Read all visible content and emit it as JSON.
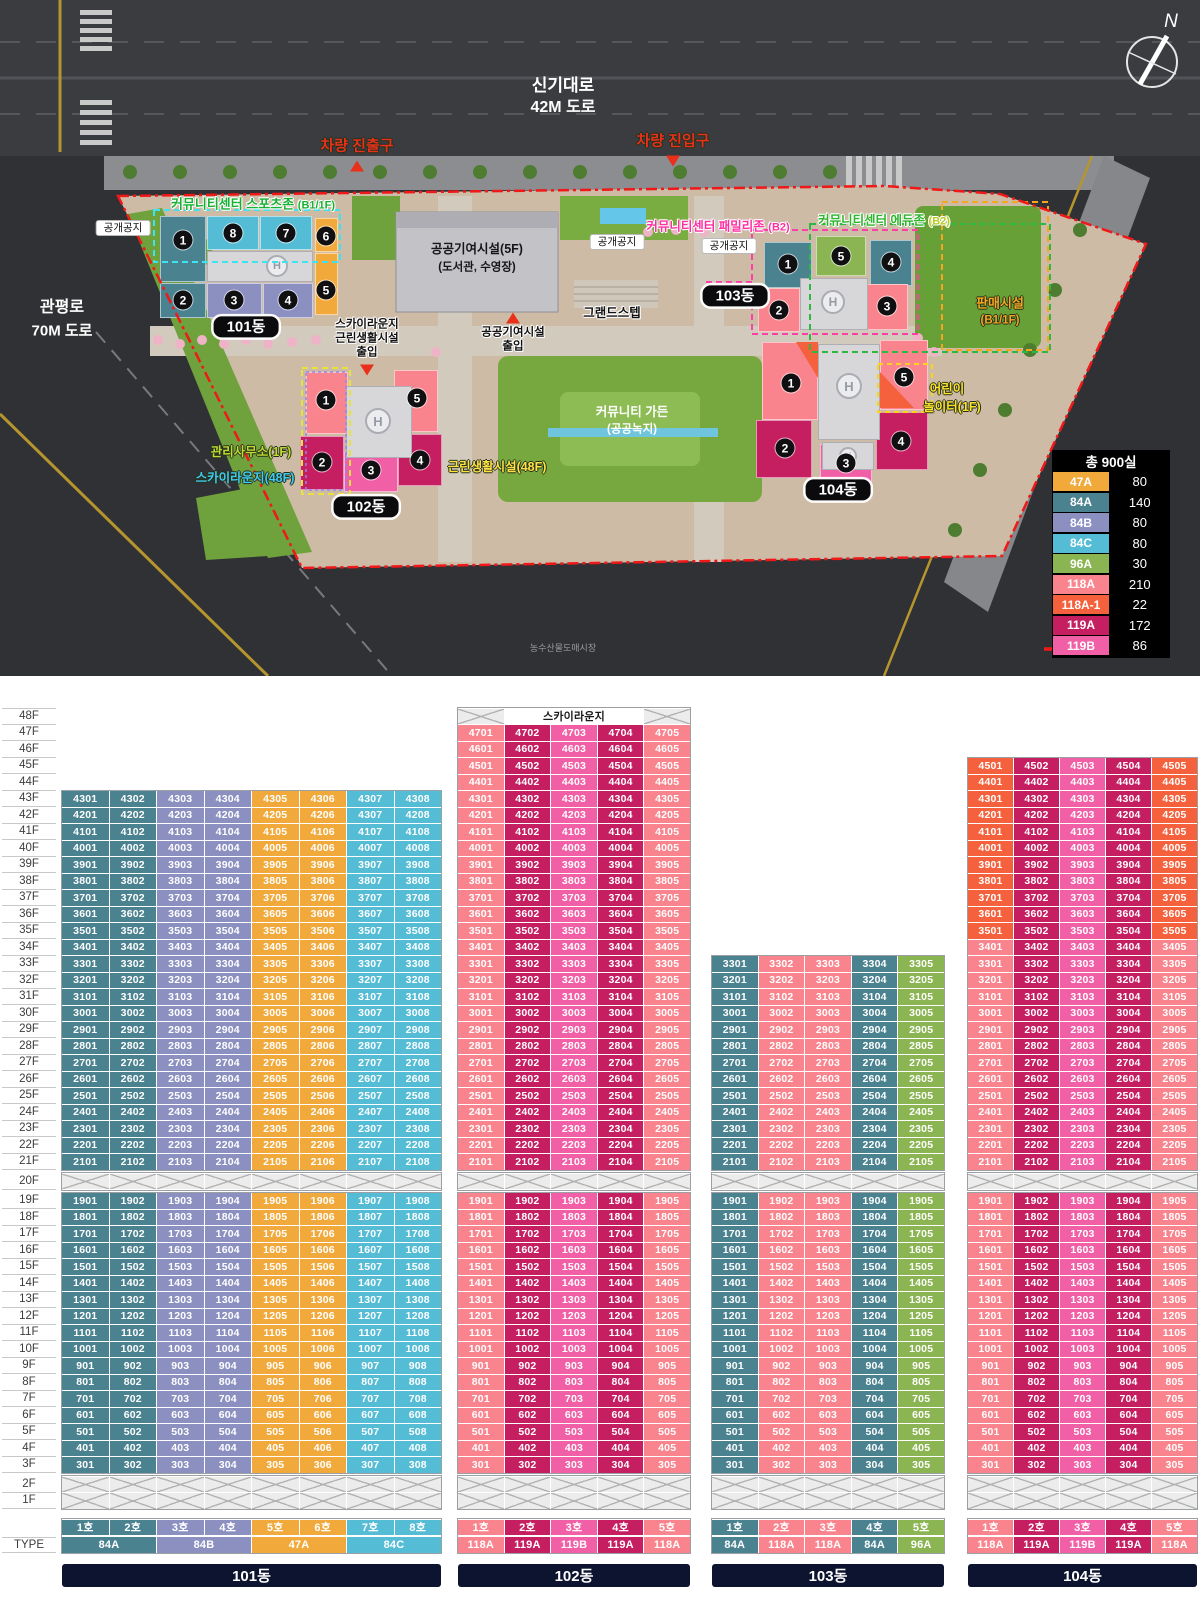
{
  "site_plan": {
    "compass_label": "N",
    "helipad_label": "H",
    "roads": {
      "top_name": "신기대로",
      "top_size": "42M 도로",
      "left_name": "관평로",
      "left_size": "70M 도로"
    },
    "gates": {
      "exit": "차량 진출구",
      "entry": "차량 진입구"
    },
    "open_space": "공개공지",
    "zones": {
      "sports": "커뮤니티센터 스포츠존",
      "sports_sub": "(B1/1F)",
      "family": "커뮤니티센터 패밀리존",
      "family_sub": "(B2)",
      "edu": "커뮤니티센터 에듀존",
      "edu_sub": "(B2)"
    },
    "labels": {
      "public_facility": "공공기여시설(5F)",
      "public_facility_sub": "(도서관, 수영장)",
      "public_entry_1": "공공기여시설",
      "public_entry_2": "출입",
      "sky_entry_1": "스카이라운지",
      "sky_entry_2": "근린생활시설",
      "sky_entry_3": "출입",
      "grand_step": "그랜드스텝",
      "sales": "판매시설",
      "sales_sub": "(B1/1F)",
      "mgmt_office": "관리사무소(1F)",
      "sky_lounge": "스카이라운지(48F)",
      "neighborhood": "근린생활시설(48F)",
      "garden": "커뮤니티 가든",
      "garden_sub": "(공공녹지)",
      "playground_1": "어린이",
      "playground_2": "놀이터(1F)",
      "market": "농수산물도매시장",
      "boundary": "대지경계선"
    },
    "badges": [
      "101동",
      "102동",
      "103동",
      "104동"
    ],
    "unit_circles": [
      [
        "1",
        "8",
        "7",
        "6",
        "2",
        "3",
        "4",
        "5"
      ],
      [
        "1",
        "5",
        "2",
        "3",
        "4"
      ],
      [
        "1",
        "5",
        "4",
        "2",
        "3"
      ],
      [
        "1",
        "5",
        "2",
        "3",
        "4"
      ]
    ],
    "legend": {
      "title": "총 900실",
      "rows": [
        {
          "type": "47A",
          "count": "80"
        },
        {
          "type": "84A",
          "count": "140"
        },
        {
          "type": "84B",
          "count": "80"
        },
        {
          "type": "84C",
          "count": "80"
        },
        {
          "type": "96A",
          "count": "30"
        },
        {
          "type": "118A",
          "count": "210"
        },
        {
          "type": "118A-1",
          "count": "22"
        },
        {
          "type": "119A",
          "count": "172"
        },
        {
          "type": "119B",
          "count": "86"
        }
      ]
    }
  },
  "colors": {
    "47A": "#F2A93B",
    "84A": "#4B8290",
    "84B": "#8B90C1",
    "84C": "#55BCD6",
    "96A": "#8BB553",
    "118A": "#F9848D",
    "118A-1": "#F4613C",
    "119A": "#C51F62",
    "119B": "#F160A6",
    "bar_navy": "#0D1430",
    "boundary_red": "#F01818"
  },
  "stack": {
    "floor_suffix": "F",
    "type_label": "TYPE",
    "sky_lounge_header": "스카이라운지",
    "max_floor": 48,
    "hatched_floors": [
      20,
      2,
      1
    ],
    "buildings": [
      {
        "name": "101동",
        "top_floor": 43,
        "columns": [
          {
            "ho": "1호",
            "type": "84A"
          },
          {
            "ho": "2호",
            "type": "84A"
          },
          {
            "ho": "3호",
            "type": "84B"
          },
          {
            "ho": "4호",
            "type": "84B"
          },
          {
            "ho": "5호",
            "type": "47A"
          },
          {
            "ho": "6호",
            "type": "47A"
          },
          {
            "ho": "7호",
            "type": "84C"
          },
          {
            "ho": "8호",
            "type": "84C"
          }
        ],
        "type_row": [
          {
            "label": "84A",
            "span": 2
          },
          {
            "label": "84B",
            "span": 2
          },
          {
            "label": "47A",
            "span": 2
          },
          {
            "label": "84C",
            "span": 2
          }
        ],
        "overrides": [
          {
            "floor": 42,
            "col": 7,
            "text": "4307"
          }
        ]
      },
      {
        "name": "102동",
        "top_floor": 47,
        "sky_lounge": true,
        "columns": [
          {
            "ho": "1호",
            "type": "118A"
          },
          {
            "ho": "2호",
            "type": "119A"
          },
          {
            "ho": "3호",
            "type": "119B"
          },
          {
            "ho": "4호",
            "type": "119A"
          },
          {
            "ho": "5호",
            "type": "118A"
          }
        ],
        "type_row": [
          {
            "label": "118A",
            "span": 1
          },
          {
            "label": "119A",
            "span": 1
          },
          {
            "label": "119B",
            "span": 1
          },
          {
            "label": "119A",
            "span": 1
          },
          {
            "label": "118A",
            "span": 1
          }
        ]
      },
      {
        "name": "103동",
        "top_floor": 33,
        "columns": [
          {
            "ho": "1호",
            "type": "84A"
          },
          {
            "ho": "2호",
            "type": "118A"
          },
          {
            "ho": "3호",
            "type": "118A"
          },
          {
            "ho": "4호",
            "type": "84A"
          },
          {
            "ho": "5호",
            "type": "96A"
          }
        ],
        "type_row": [
          {
            "label": "84A",
            "span": 1
          },
          {
            "label": "118A",
            "span": 1
          },
          {
            "label": "118A",
            "span": 1
          },
          {
            "label": "84A",
            "span": 1
          },
          {
            "label": "96A",
            "span": 1
          }
        ]
      },
      {
        "name": "104동",
        "top_floor": 45,
        "columns": [
          {
            "ho": "1호",
            "type": "118A",
            "alt_type": "118A-1",
            "alt_from": 35
          },
          {
            "ho": "2호",
            "type": "119A"
          },
          {
            "ho": "3호",
            "type": "119B"
          },
          {
            "ho": "4호",
            "type": "119A"
          },
          {
            "ho": "5호",
            "type": "118A",
            "alt_type": "118A-1",
            "alt_from": 35
          }
        ],
        "type_row": [
          {
            "label": "118A",
            "span": 1
          },
          {
            "label": "119A",
            "span": 1
          },
          {
            "label": "119B",
            "span": 1
          },
          {
            "label": "119A",
            "span": 1
          },
          {
            "label": "118A",
            "span": 1
          }
        ]
      }
    ]
  }
}
